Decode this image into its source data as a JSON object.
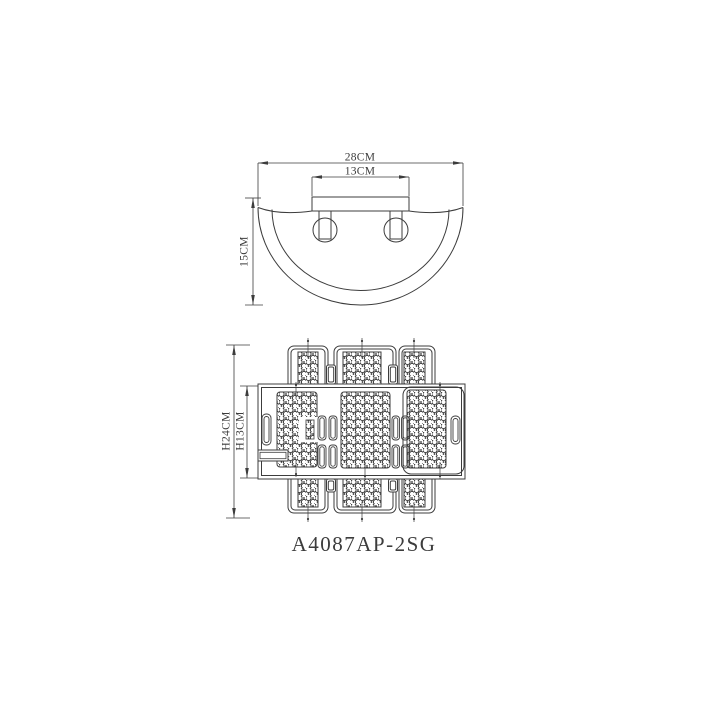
{
  "drawing": {
    "background_color": "#ffffff",
    "line_color": "#3c3c3c",
    "part_number": "A4087AP-2SG",
    "top_view": {
      "dim_width_outer": "28CM",
      "dim_width_inner": "13CM",
      "dim_height": "15CM"
    },
    "bottom_view": {
      "dim_height_outer": "H24CM",
      "dim_height_inner": "H13CM"
    }
  }
}
